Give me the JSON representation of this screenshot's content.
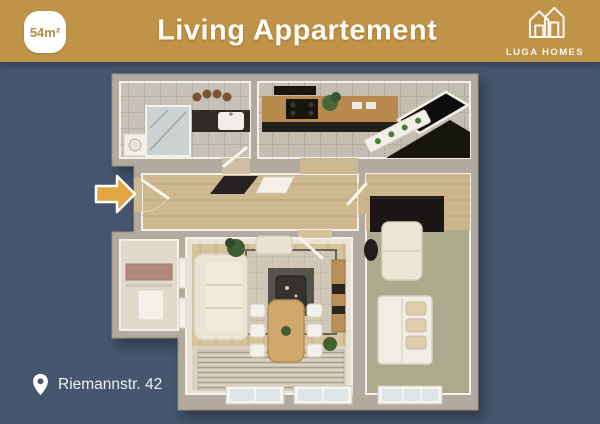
{
  "header": {
    "title": "Living Appartement",
    "area_badge": "54m²",
    "brand_name": "LUGA HOMES"
  },
  "footer": {
    "address": "Riemannstr. 42"
  },
  "colors": {
    "header_bg": "#bf9348",
    "page_bg": "#47566f",
    "badge_text": "#b38c3f",
    "arrow": "#e3a53f",
    "text_light": "#f7f6f2"
  },
  "floor_plan": {
    "type": "3d-top-down-apartment-render",
    "rooms": [
      "bathroom",
      "kitchen",
      "hallway",
      "living-room-with-dining",
      "bedroom",
      "storage-closet"
    ],
    "furniture": [
      "shower",
      "vanity-sink",
      "washing-machine",
      "kitchen-counter",
      "cooktop",
      "kitchen-island",
      "glossy-kitchen-table",
      "herb-pots",
      "sofa",
      "area-rug",
      "coffee-table",
      "ottoman",
      "dining-table",
      "dining-chairs",
      "sideboard",
      "wardrobe",
      "love-seat",
      "double-bed",
      "striped-runner",
      "windows",
      "entrance-door"
    ]
  }
}
